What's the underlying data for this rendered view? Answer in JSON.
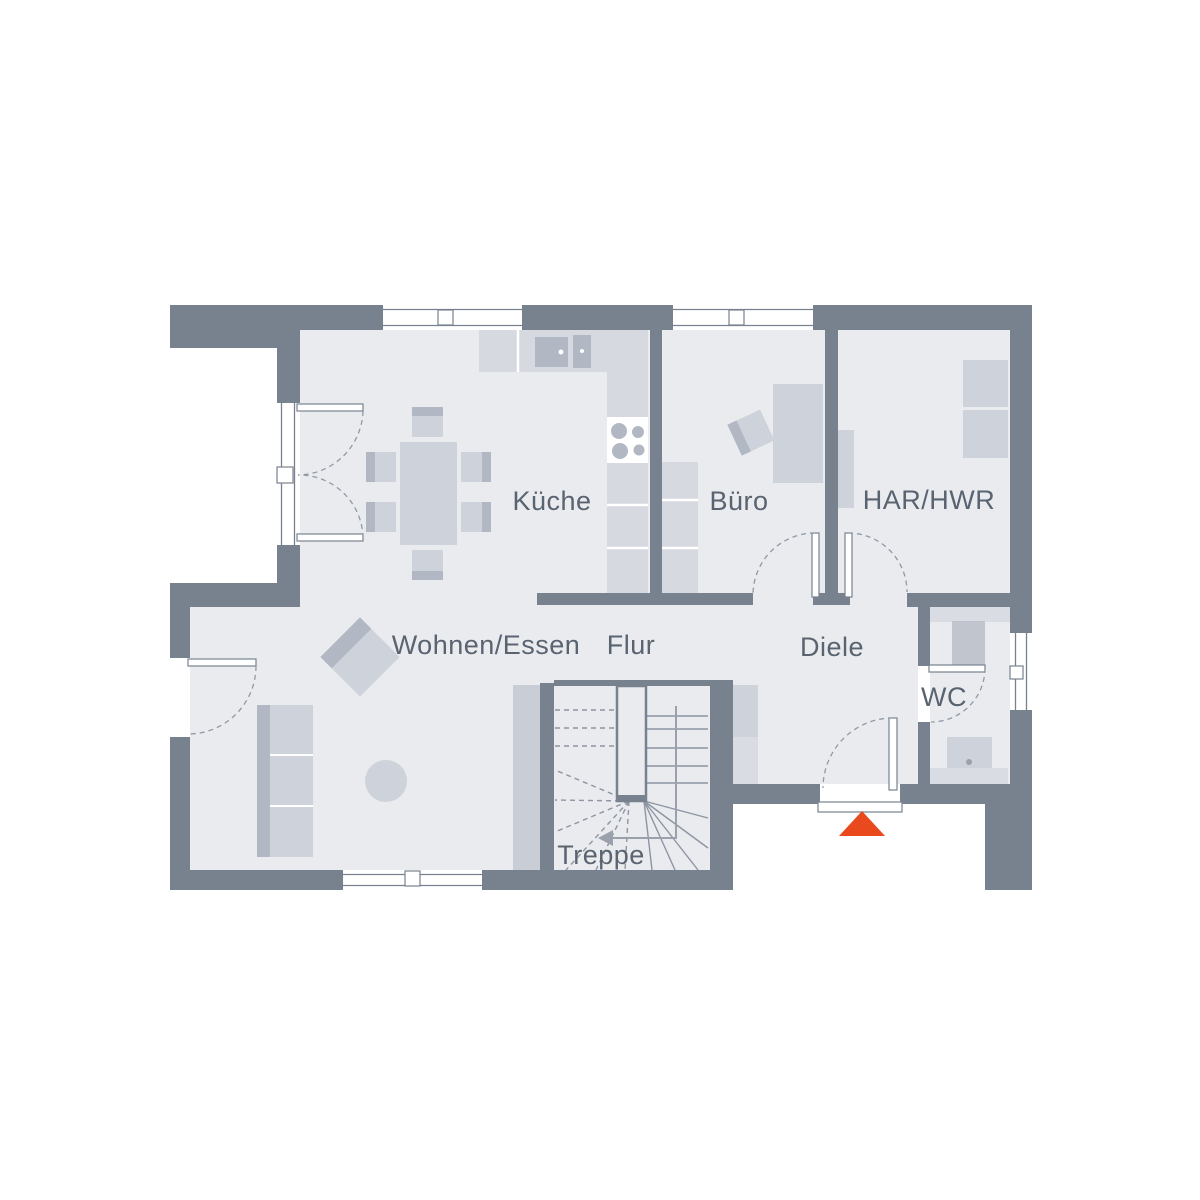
{
  "colors": {
    "bg": "#ffffff",
    "wall": "#78828f",
    "floor": "#e9ebef",
    "furn": "#ced2da",
    "furndark": "#b2b8c3",
    "counter": "#d6d9df",
    "counterlight": "#d9dce2",
    "column": "#c9cdd6",
    "dash": "#9099a6",
    "stairline": "#8d95a2",
    "walk": "#9aa1ac",
    "text": "#5a6370",
    "accent": "#e8491d"
  },
  "rooms": [
    {
      "id": "kueche",
      "label": "Küche"
    },
    {
      "id": "buero",
      "label": "Büro"
    },
    {
      "id": "har-hwr",
      "label": "HAR/HWR"
    },
    {
      "id": "wohnen-essen",
      "label": "Wohnen/Essen"
    },
    {
      "id": "flur",
      "label": "Flur"
    },
    {
      "id": "diele",
      "label": "Diele"
    },
    {
      "id": "wc",
      "label": "WC"
    },
    {
      "id": "treppe",
      "label": "Treppe"
    }
  ],
  "entrance": {
    "marker": "entrance-arrow",
    "direction": "up"
  }
}
